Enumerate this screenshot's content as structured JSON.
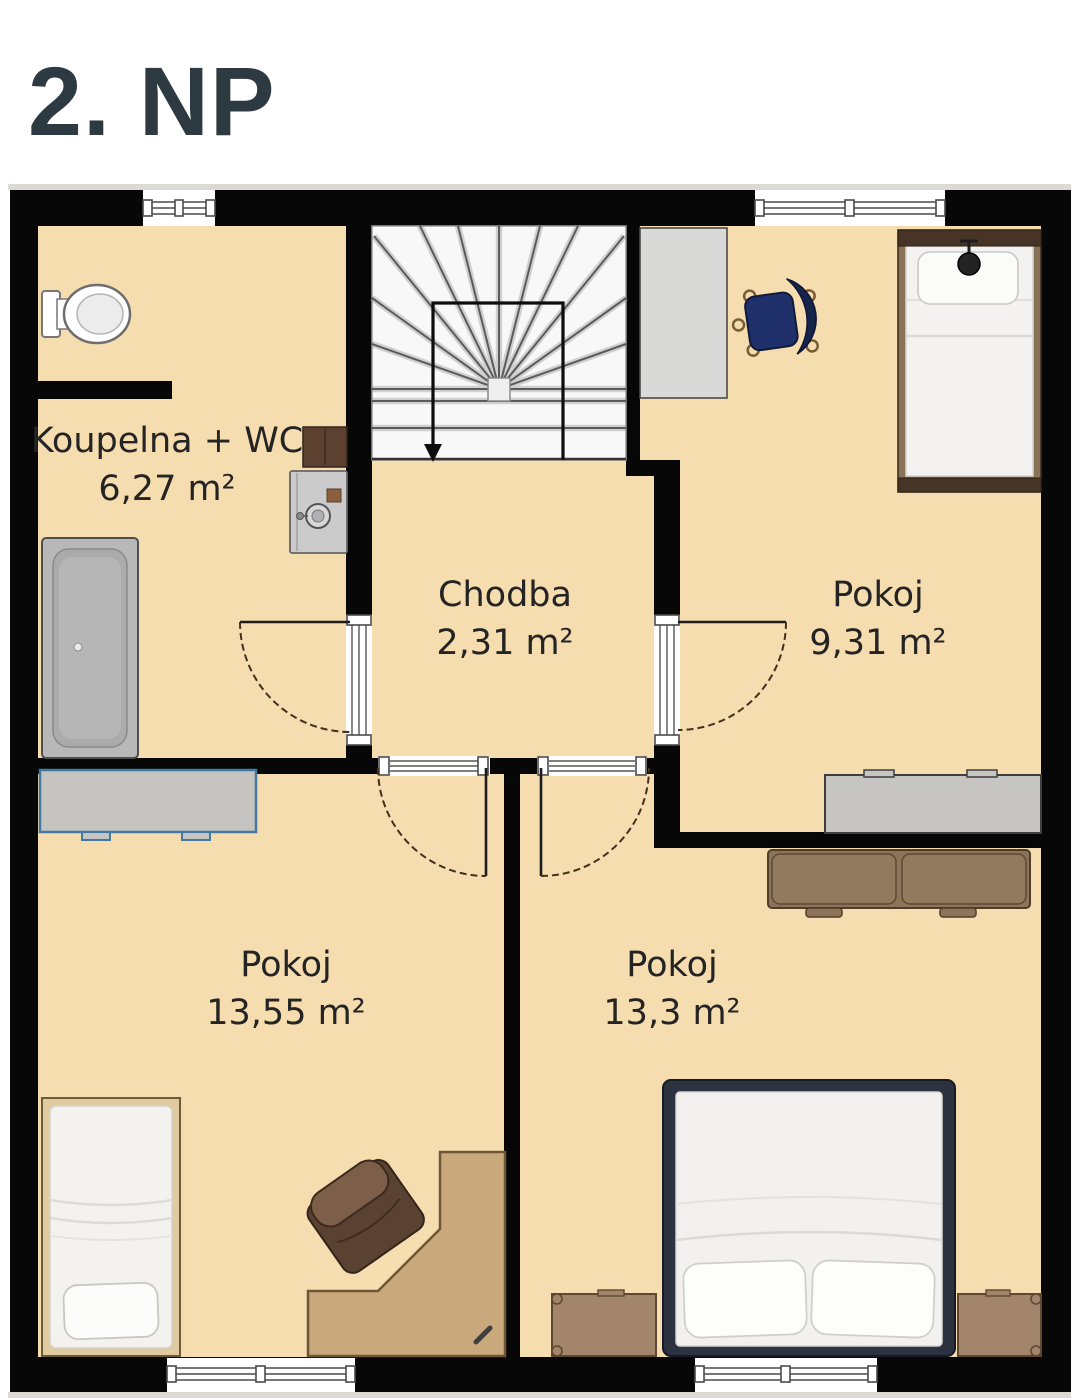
{
  "title": "2. NP",
  "rooms": [
    {
      "name": "Koupelna + WC",
      "area": "6,27 m²"
    },
    {
      "name": "Chodba",
      "area": "2,31 m²"
    },
    {
      "name": "Pokoj",
      "area": "9,31 m²"
    },
    {
      "name": "Pokoj",
      "area": "13,55 m²"
    },
    {
      "name": "Pokoj",
      "area": "13,3 m²"
    }
  ],
  "colors": {
    "floor": "#f5ddb0",
    "wall": "#070707",
    "title_text": "#2d3a42",
    "label_text": "#242424",
    "stairs": "#f8f8f8",
    "wardrobe_gray": "#d9d9d8",
    "dresser_concrete": "#c7c5c2",
    "dresser_blue_border": "#4179a3",
    "sofa_brown": "#8d7458",
    "armchair_leather": "#5a4232",
    "desk_wood": "#c9a87b",
    "nightstand_wood": "#a2856a",
    "double_bed_frame": "#2c3240",
    "single_bed_frame": "#8a7257",
    "office_chair_navy": "#1f2f66"
  }
}
